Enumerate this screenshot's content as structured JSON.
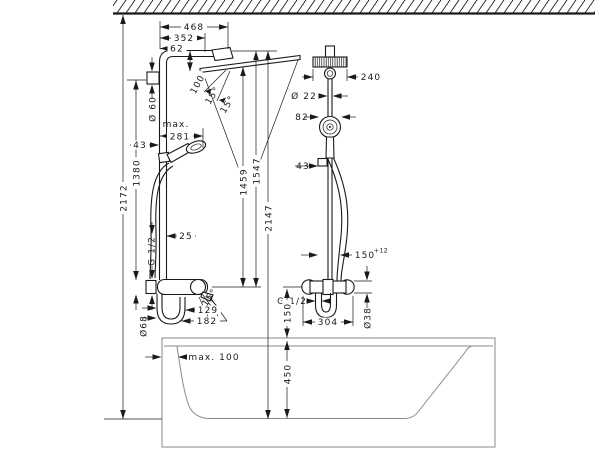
{
  "page": {
    "type": "technical-installation-drawing",
    "subject": "showerpipe units over bathtub, dimensions in mm",
    "line_color": "#1a1a1a",
    "bathtub_line_color": "#8a8a8a",
    "background": "#ffffff"
  },
  "left_unit": {
    "dims": {
      "overall_height": "2172",
      "bar_height": "1380",
      "escutcheon_diameter": "Ø 60",
      "projection_total": "468",
      "projection_arm": "352",
      "offset": "62",
      "arm_drop": "100",
      "spray_angle_1": "15°",
      "spray_angle_2": "15°",
      "handshower_max_label": "max.",
      "handshower_max_value": "281",
      "holder_offset": "43",
      "pipe_offset": "25",
      "connection_thread": "G 1/2",
      "spout_angle": "15°",
      "loop_diameter": "Ø68",
      "spout_reach_inner": "129",
      "spout_reach_outer": "182",
      "height_spray": "1459",
      "height_head": "1547",
      "height_top": "2147"
    }
  },
  "right_unit": {
    "dims": {
      "head_width": "240",
      "pipe_diameter": "Ø 22",
      "handshower_diameter": "82",
      "holder_offset": "43",
      "connection_distance": "150",
      "connection_tolerance": "+12",
      "connection_thread": "G 1/2",
      "valve_height_above_rim": "150",
      "valve_width": "304",
      "valve_diameter": "Ø38"
    }
  },
  "bathtub": {
    "dims": {
      "rim_to_axis_max": "max. 100",
      "depth": "450"
    }
  }
}
